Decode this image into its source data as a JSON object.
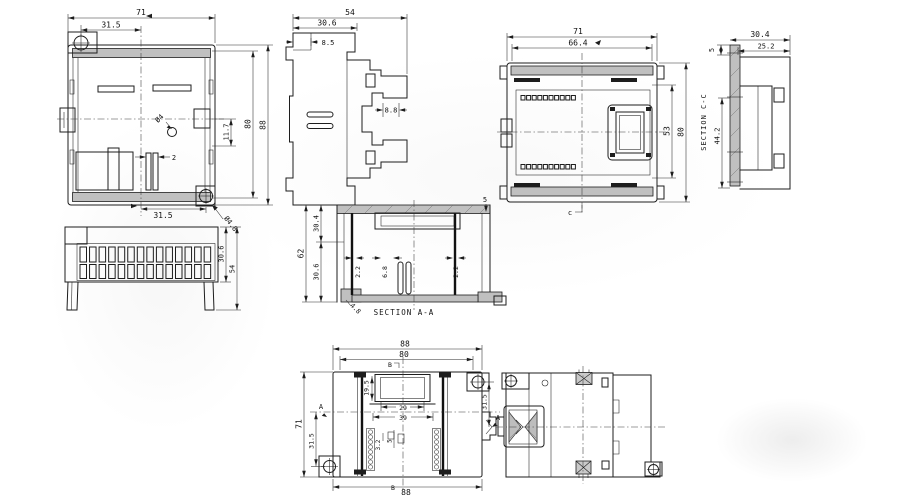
{
  "canvas": {
    "background": "#ffffff",
    "line_color": "#1d1d1d",
    "section_fill": "#c0c0c0"
  },
  "views": {
    "rear": {
      "dims": {
        "w71": "71",
        "off315_top": "31.5",
        "h80": "80",
        "h88": "88",
        "d117": "11.7",
        "dia4": "Ø4",
        "s2": "2",
        "off315_bot": "31.5",
        "dia48": "Ø4.8"
      }
    },
    "profile": {
      "dims": {
        "d54": "54",
        "d306": "30.6",
        "d85": "8.5",
        "d88": "8.8"
      }
    },
    "front": {
      "dims": {
        "w71": "71",
        "w664": "66.4",
        "h80": "80",
        "h53": "53",
        "mark_c": "c"
      }
    },
    "section_cc": {
      "label": "SECTION C-C",
      "dims": {
        "d304": "30.4",
        "d252": "25.2",
        "t5": "5",
        "h442": "44.2"
      }
    },
    "terminal": {
      "dims": {
        "h306": "30.6",
        "h54": "54"
      }
    },
    "section_aa": {
      "label": "SECTION A-A",
      "dims": {
        "h62": "62",
        "h304": "30.4",
        "h306": "30.6",
        "t22l": "2.2",
        "w68": "6.8",
        "t22r": "2.2",
        "t48": "4.8",
        "t5": "5"
      }
    },
    "top": {
      "dims": {
        "w88t": "88",
        "w80": "80",
        "d195": "19.5",
        "w29": "29",
        "w39": "39",
        "p32": "3.2",
        "p5": "5",
        "off315r": "31.5",
        "h71": "71",
        "off315l": "31.5",
        "w88b": "88",
        "mark_a_l": "A",
        "mark_a_r": "A",
        "mark_b_t": "B",
        "mark_b_b": "B"
      }
    }
  }
}
